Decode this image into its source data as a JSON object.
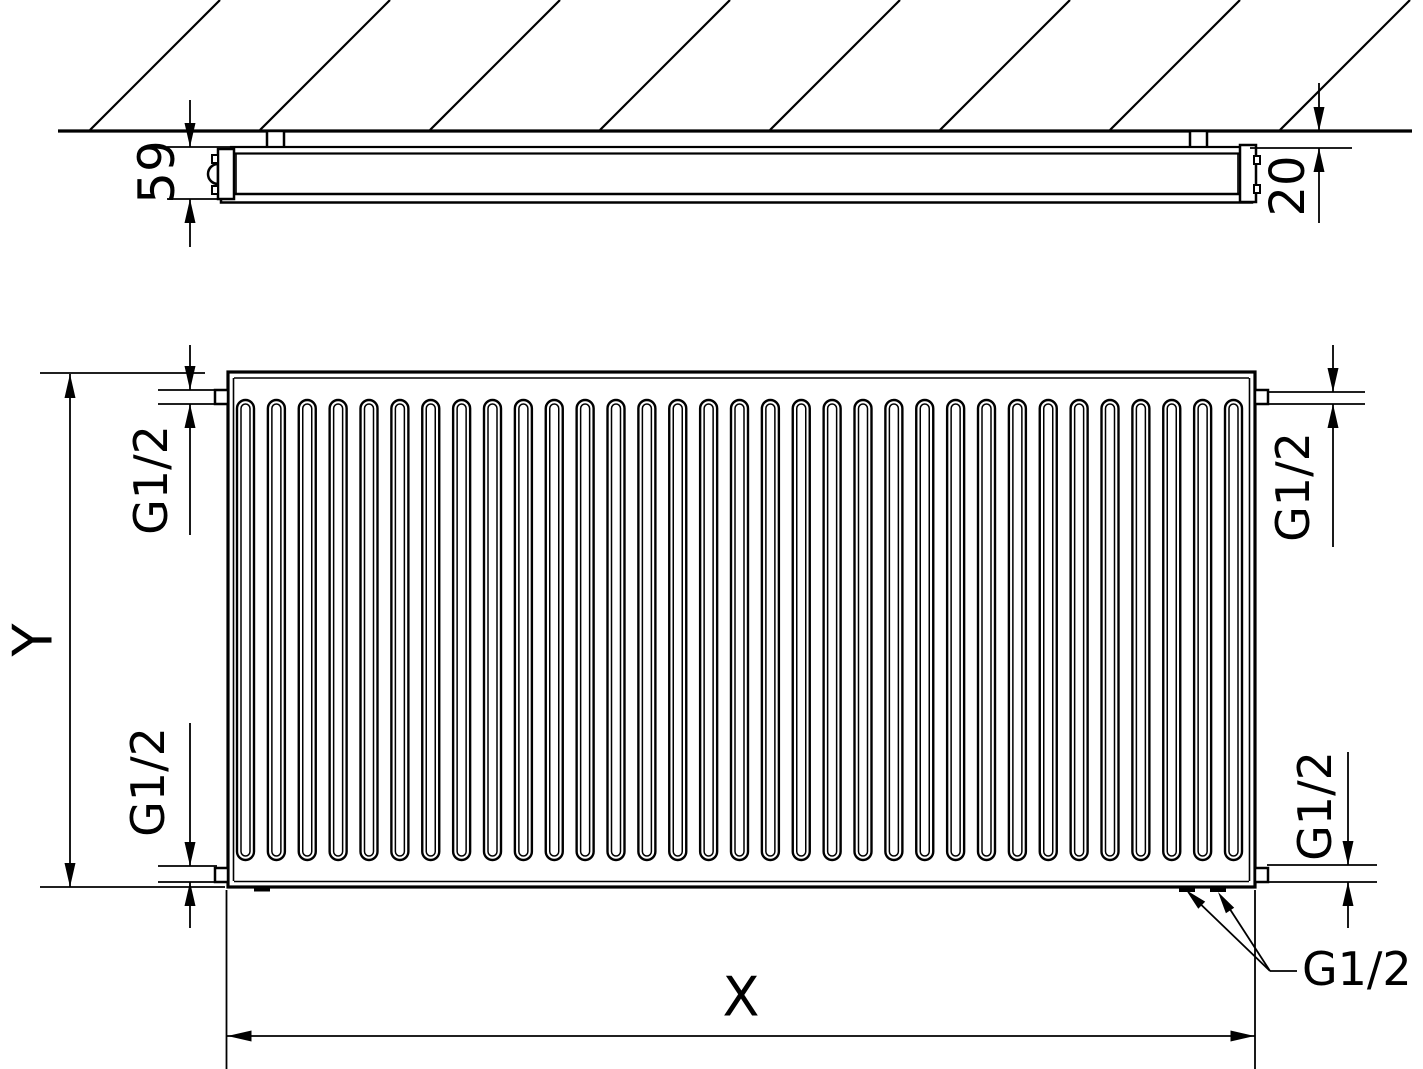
{
  "drawing": {
    "labels": {
      "top_view": {
        "depth": "59",
        "wall_gap": "20"
      },
      "front_view": {
        "height": "Y",
        "width": "X",
        "conn_top_left": "G1/2",
        "conn_bottom_left": "G1/2",
        "conn_top_right": "G1/2",
        "conn_bottom_right": "G1/2",
        "conn_bottom_leader": "G1/2"
      }
    },
    "front_view": {
      "corrugation_count": 33
    },
    "colors": {
      "line": "#000000",
      "background": "#ffffff"
    }
  }
}
